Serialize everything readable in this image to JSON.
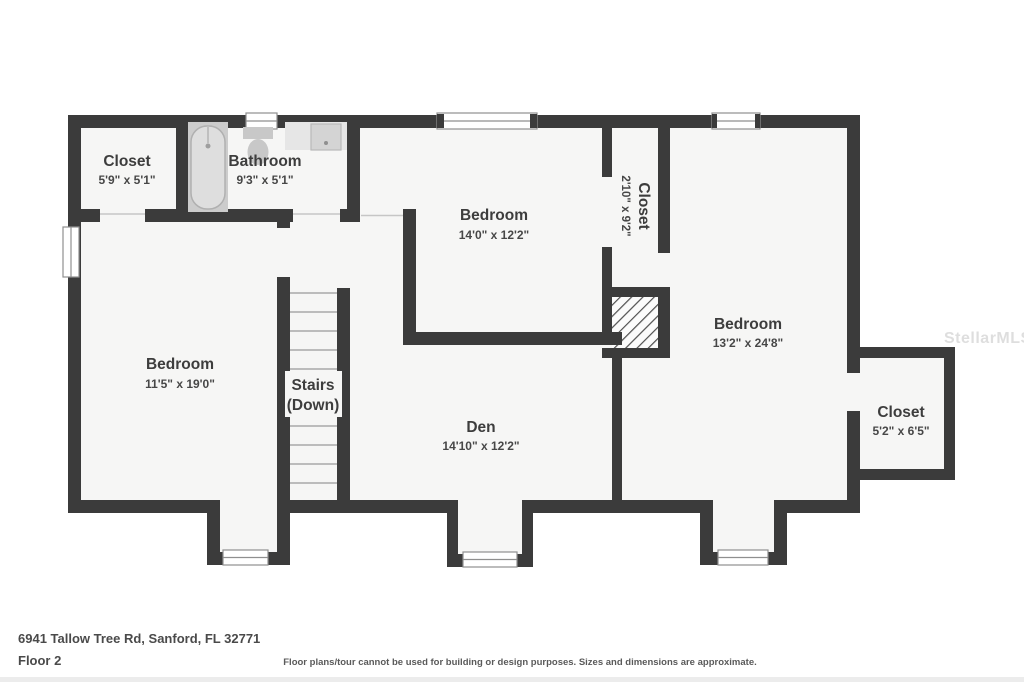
{
  "watermark": "StellarMLS",
  "footer": {
    "address": "6941 Tallow Tree Rd, Sanford, FL 32771",
    "floor_label": "Floor 2",
    "disclaimer": "Floor plans/tour cannot be used for building or design purposes. Sizes and dimensions are approximate."
  },
  "rooms": {
    "closet_top_left": {
      "name": "Closet",
      "dims": "5'9\" x 5'1\""
    },
    "bathroom": {
      "name": "Bathroom",
      "dims": "9'3\" x 5'1\""
    },
    "bedroom_top": {
      "name": "Bedroom",
      "dims": "14'0\" x 12'2\""
    },
    "closet_tall": {
      "name": "Closet",
      "dims": "2'10\" x 9'2\""
    },
    "bedroom_right": {
      "name": "Bedroom",
      "dims": "13'2\" x 24'8\""
    },
    "bedroom_left": {
      "name": "Bedroom",
      "dims": "11'5\" x 19'0\""
    },
    "stairs": {
      "name": "Stairs",
      "dims": "(Down)"
    },
    "den": {
      "name": "Den",
      "dims": "14'10\" x 12'2\""
    },
    "closet_right": {
      "name": "Closet",
      "dims": "5'2\" x 6'5\""
    }
  },
  "colors": {
    "wall": "#3b3b3b",
    "room_fill": "#f6f6f5",
    "fixture": "#c8c8c8",
    "label": "#3d3d3d"
  }
}
